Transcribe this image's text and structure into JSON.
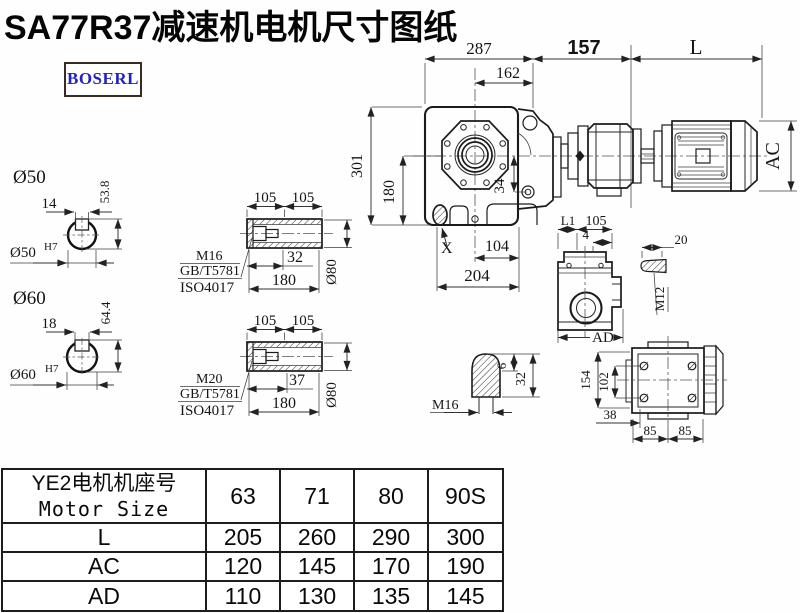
{
  "page": {
    "title": "SA77R37减速机电机尺寸图纸",
    "logo": "BOSERL"
  },
  "main_view": {
    "dims": {
      "width_total": "287",
      "width_inner": "162",
      "gap": "157",
      "motor_len": "L",
      "height_total": "301",
      "height_axis": "180",
      "offset": "34",
      "mark": "X",
      "foot_inner": "104",
      "foot_outer": "204",
      "motor_dia": "AC"
    }
  },
  "shaft50": {
    "dia": "Ø50",
    "keyway": "14",
    "depth": "53.8",
    "bore": "Ø50",
    "fit": "H7"
  },
  "shaft60": {
    "dia": "Ø60",
    "keyway": "18",
    "depth": "64.4",
    "bore": "Ø60",
    "fit": "H7"
  },
  "hollow_top": {
    "half1": "105",
    "half2": "105",
    "thread": "M16",
    "std1": "GB/T5781",
    "std2": "ISO4017",
    "depth": "32",
    "length": "180",
    "dia": "Ø80"
  },
  "hollow_bottom": {
    "half1": "105",
    "half2": "105",
    "thread": "M20",
    "std1": "GB/T5781",
    "std2": "ISO4017",
    "depth": "37",
    "length": "180",
    "dia": "Ø80"
  },
  "plug": {
    "height": "6",
    "total": "32",
    "thread": "M16"
  },
  "side_view": {
    "l1": "L1",
    "d105": "105",
    "d4": "4",
    "ad": "AD",
    "key_len": "20",
    "key_thread": "M12"
  },
  "rear_view": {
    "height": "154",
    "bolt_v": "102",
    "edge": "38",
    "bolt_h1": "85",
    "bolt_h2": "85"
  },
  "spec_table": {
    "header_cn": "YE2电机机座号",
    "header_en": "Motor Size",
    "columns": [
      "63",
      "71",
      "80",
      "90S"
    ],
    "rows": [
      {
        "label": "L",
        "values": [
          "205",
          "260",
          "290",
          "300"
        ]
      },
      {
        "label": "AC",
        "values": [
          "120",
          "145",
          "170",
          "190"
        ]
      },
      {
        "label": "AD",
        "values": [
          "110",
          "130",
          "135",
          "145"
        ]
      }
    ]
  }
}
